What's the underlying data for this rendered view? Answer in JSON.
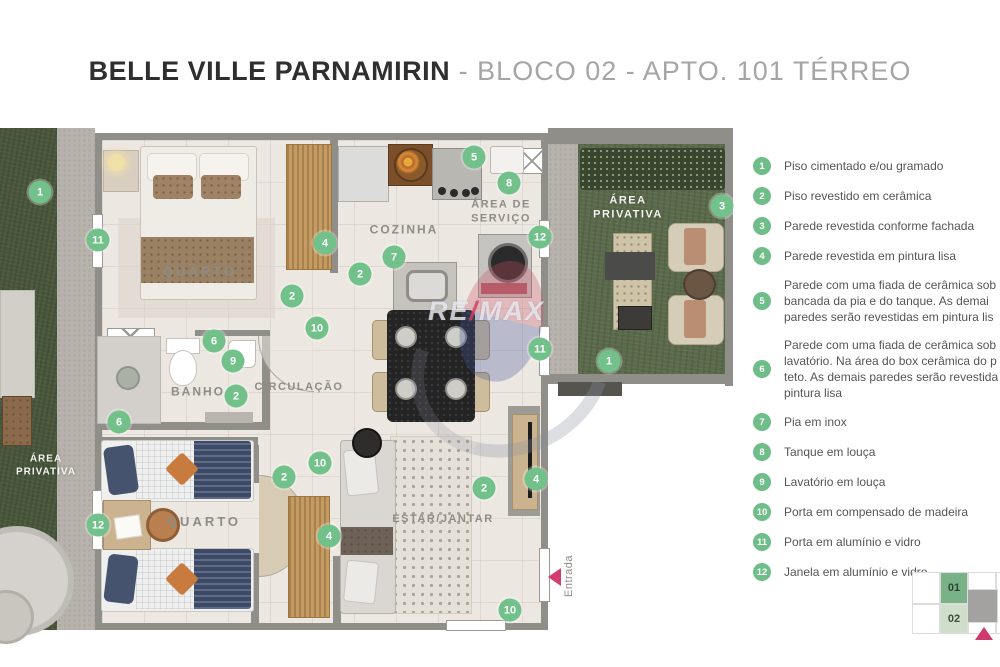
{
  "title": {
    "main": "BELLE VILLE PARNAMIRIN",
    "rest": " - BLOCO 02 - APTO. 101 TÉRREO"
  },
  "plan": {
    "rooms": [
      {
        "label": "QUARTO",
        "x": 200,
        "y": 144,
        "style": "dark",
        "fs": 13,
        "ls": 3
      },
      {
        "label": "COZINHA",
        "x": 404,
        "y": 102,
        "style": "dark",
        "fs": 12,
        "ls": 2
      },
      {
        "label": "ÁREA DE\nSERVIÇO",
        "x": 501,
        "y": 84,
        "style": "dark",
        "fs": 11,
        "ls": 1.5
      },
      {
        "label": "ÁREA\nPRIVATIVA",
        "x": 628,
        "y": 80,
        "style": "light",
        "fs": 11,
        "ls": 1.5
      },
      {
        "label": "BANHO",
        "x": 198,
        "y": 264,
        "style": "dark",
        "fs": 12,
        "ls": 2
      },
      {
        "label": "CIRCULAÇÃO",
        "x": 299,
        "y": 260,
        "style": "dark",
        "fs": 11,
        "ls": 1.5
      },
      {
        "label": "QUARTO",
        "x": 204,
        "y": 394,
        "style": "dark",
        "fs": 13,
        "ls": 3
      },
      {
        "label": "ESTAR/JANTAR",
        "x": 443,
        "y": 392,
        "style": "dark",
        "fs": 11,
        "ls": 1.5
      },
      {
        "label": "ÁREA\nPRIVATIVA",
        "x": 46,
        "y": 338,
        "style": "light",
        "fs": 10,
        "ls": 1
      }
    ],
    "markers": [
      {
        "n": "1",
        "x": 40,
        "y": 64
      },
      {
        "n": "11",
        "x": 98,
        "y": 112
      },
      {
        "n": "4",
        "x": 325,
        "y": 115
      },
      {
        "n": "2",
        "x": 292,
        "y": 168
      },
      {
        "n": "10",
        "x": 317,
        "y": 200
      },
      {
        "n": "6",
        "x": 214,
        "y": 213
      },
      {
        "n": "9",
        "x": 233,
        "y": 233
      },
      {
        "n": "2",
        "x": 236,
        "y": 268
      },
      {
        "n": "6",
        "x": 119,
        "y": 294
      },
      {
        "n": "2",
        "x": 284,
        "y": 349
      },
      {
        "n": "10",
        "x": 320,
        "y": 335
      },
      {
        "n": "12",
        "x": 98,
        "y": 397
      },
      {
        "n": "4",
        "x": 329,
        "y": 408
      },
      {
        "n": "7",
        "x": 394,
        "y": 129
      },
      {
        "n": "2",
        "x": 360,
        "y": 146
      },
      {
        "n": "5",
        "x": 474,
        "y": 29
      },
      {
        "n": "8",
        "x": 509,
        "y": 55
      },
      {
        "n": "12",
        "x": 540,
        "y": 109
      },
      {
        "n": "11",
        "x": 540,
        "y": 221
      },
      {
        "n": "3",
        "x": 722,
        "y": 78
      },
      {
        "n": "1",
        "x": 609,
        "y": 233
      },
      {
        "n": "2",
        "x": 484,
        "y": 360
      },
      {
        "n": "4",
        "x": 536,
        "y": 351
      },
      {
        "n": "10",
        "x": 510,
        "y": 482
      }
    ],
    "entrance_label": "Entrada",
    "watermark": {
      "left": "RE",
      "slash": "/",
      "right": "MAX"
    }
  },
  "legend": {
    "items": [
      {
        "n": "1",
        "text": "Piso cimentado e/ou gramado"
      },
      {
        "n": "2",
        "text": "Piso revestido em cerâmica"
      },
      {
        "n": "3",
        "text": "Parede revestida conforme fachada"
      },
      {
        "n": "4",
        "text": "Parede revestida em pintura lisa"
      },
      {
        "n": "5",
        "text": "Parede com uma fiada de cerâmica sob\nbancada da pia e do tanque. As demai\nparedes serão revestidas em pintura lis"
      },
      {
        "n": "6",
        "text": "Parede com uma fiada de cerâmica sob\nlavatório. Na área do box cerâmica do p\nteto. As demais paredes serão revestida\npintura lisa"
      },
      {
        "n": "7",
        "text": "Pia em inox"
      },
      {
        "n": "8",
        "text": "Tanque em louça"
      },
      {
        "n": "9",
        "text": "Lavatório em louça"
      },
      {
        "n": "10",
        "text": "Porta em compensado de madeira"
      },
      {
        "n": "11",
        "text": "Porta em alumínio e vidro"
      },
      {
        "n": "12",
        "text": "Janela em alumínio e vidro"
      }
    ]
  },
  "minimap": {
    "unit_top": "01",
    "unit_bottom": "02"
  },
  "colors": {
    "marker_green": "#72c18b",
    "entrance_pink": "#d23c70",
    "wall_gray": "#8f8e89"
  }
}
